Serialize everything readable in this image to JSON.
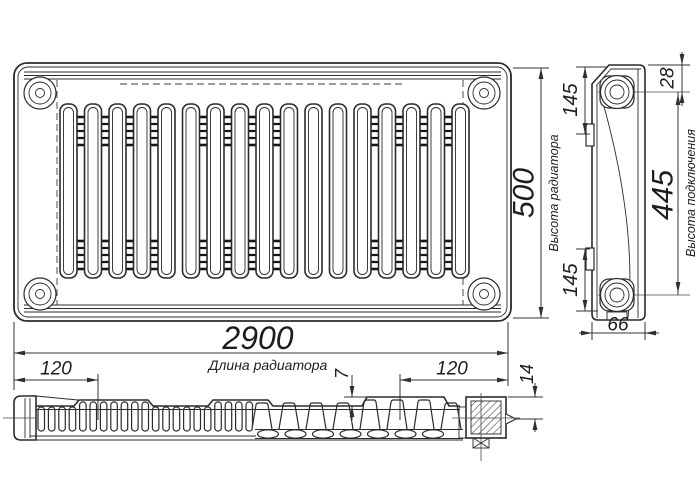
{
  "drawing_labels": {
    "dims": {
      "length": "2900",
      "height": "500",
      "connection_height": "445",
      "port_offset_top": "145",
      "port_offset_bottom": "145",
      "top_to_port": "28",
      "depth": "66",
      "bracket_offset_left": "120",
      "bracket_offset_right": "120",
      "fin_height": "7",
      "end_depth": "14"
    },
    "captions": {
      "length": "Длина радиатора",
      "height": "Высота радиатора",
      "connection": "Высота подключения"
    },
    "colors": {
      "line": "#2b2b2b",
      "dark_fin": "#161616",
      "background": "#ffffff"
    }
  }
}
